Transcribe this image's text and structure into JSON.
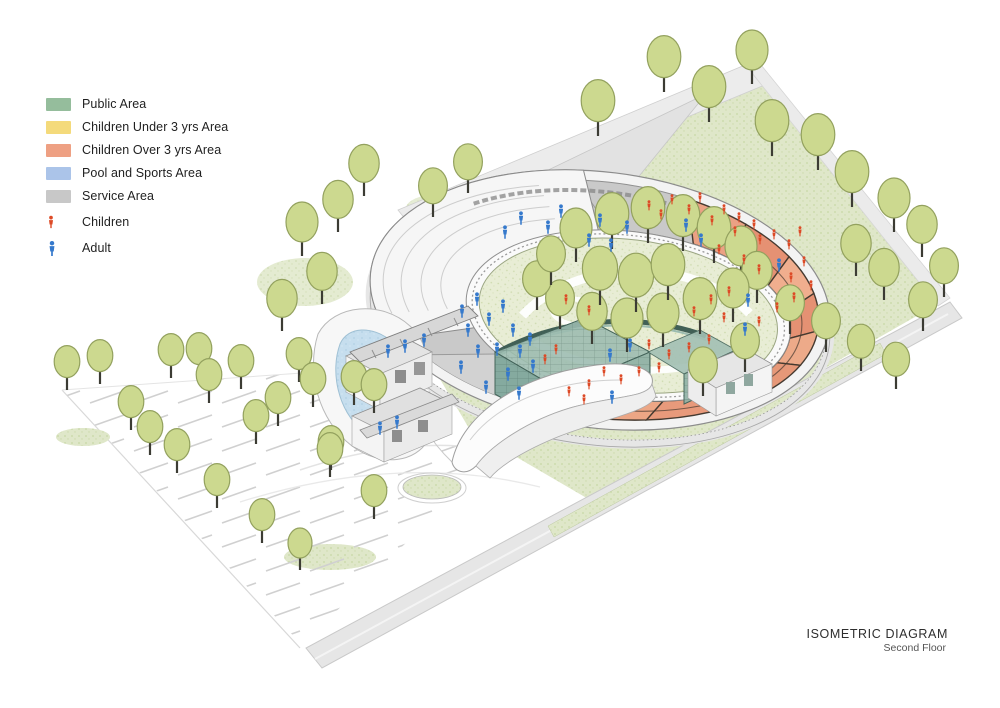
{
  "legend": {
    "items": [
      {
        "label": "Public Area",
        "color": "#95bd9c"
      },
      {
        "label": "Children Under 3 yrs Area",
        "color": "#f4da7b"
      },
      {
        "label": "Children Over 3 yrs Area",
        "color": "#eea083"
      },
      {
        "label": "Pool and Sports Area",
        "color": "#abc4e9"
      },
      {
        "label": "Service Area",
        "color": "#c8c8c8"
      }
    ],
    "figures": [
      {
        "label": "Children",
        "color": "#dd4a26",
        "icon": "child-figure-icon"
      },
      {
        "label": "Adult",
        "color": "#3579cc",
        "icon": "adult-figure-icon"
      }
    ]
  },
  "title": {
    "line1": "ISOMETRIC DIAGRAM",
    "line2": "Second Floor"
  },
  "colors": {
    "child_red": "#dd4a26",
    "adult_blue": "#3579cc",
    "tree_fill": "#ccd98f",
    "tree_stroke": "#93a15e",
    "trunk": "#3c3c34",
    "service_gray": "#c9c9c9",
    "over3_salmon": "#eba184",
    "glass_teal": "#9cbcb0",
    "glass_dark": "#2f5048",
    "pool_water": "#c6deee"
  },
  "scene": {
    "trees": {
      "courtyard": [
        [
          576,
          262,
          20
        ],
        [
          612,
          249,
          21
        ],
        [
          648,
          243,
          21
        ],
        [
          683,
          251,
          21
        ],
        [
          714,
          263,
          21
        ],
        [
          741,
          280,
          20
        ],
        [
          757,
          303,
          19
        ],
        [
          733,
          322,
          20
        ],
        [
          700,
          334,
          21
        ],
        [
          663,
          347,
          20
        ],
        [
          627,
          352,
          20
        ],
        [
          592,
          344,
          19
        ],
        [
          560,
          329,
          18
        ],
        [
          537,
          310,
          18
        ],
        [
          551,
          285,
          18
        ],
        [
          600,
          305,
          22
        ],
        [
          636,
          312,
          22
        ],
        [
          668,
          300,
          21
        ]
      ],
      "lawn": [
        [
          598,
          136,
          21
        ],
        [
          664,
          92,
          21
        ],
        [
          709,
          122,
          21
        ],
        [
          752,
          84,
          20
        ],
        [
          772,
          156,
          21
        ],
        [
          818,
          170,
          21
        ],
        [
          852,
          207,
          21
        ],
        [
          894,
          232,
          20
        ],
        [
          922,
          257,
          19
        ],
        [
          944,
          297,
          18
        ],
        [
          923,
          331,
          18
        ],
        [
          884,
          300,
          19
        ],
        [
          856,
          276,
          19
        ],
        [
          790,
          334,
          18
        ],
        [
          826,
          352,
          18
        ],
        [
          861,
          371,
          17
        ],
        [
          896,
          389,
          17
        ],
        [
          703,
          396,
          18
        ],
        [
          745,
          372,
          18
        ],
        [
          302,
          256,
          20
        ],
        [
          322,
          304,
          19
        ],
        [
          282,
          331,
          19
        ],
        [
          364,
          196,
          19
        ],
        [
          338,
          232,
          19
        ],
        [
          433,
          217,
          18
        ],
        [
          468,
          193,
          18
        ]
      ],
      "parking": [
        [
          67,
          390,
          16
        ],
        [
          100,
          384,
          16
        ],
        [
          131,
          430,
          16
        ],
        [
          171,
          378,
          16
        ],
        [
          199,
          377,
          16
        ],
        [
          209,
          403,
          16
        ],
        [
          241,
          389,
          16
        ],
        [
          256,
          444,
          16
        ],
        [
          278,
          426,
          16
        ],
        [
          299,
          382,
          16
        ],
        [
          313,
          407,
          16
        ],
        [
          331,
          470,
          16
        ],
        [
          354,
          405,
          16
        ],
        [
          374,
          413,
          16
        ],
        [
          177,
          473,
          16
        ],
        [
          217,
          508,
          16
        ],
        [
          262,
          543,
          16
        ],
        [
          330,
          477,
          16
        ],
        [
          374,
          519,
          16
        ],
        [
          300,
          570,
          15
        ],
        [
          150,
          455,
          16
        ]
      ]
    },
    "figures": {
      "adults": [
        [
          462,
          312
        ],
        [
          477,
          300
        ],
        [
          468,
          331
        ],
        [
          489,
          320
        ],
        [
          503,
          307
        ],
        [
          513,
          331
        ],
        [
          478,
          352
        ],
        [
          461,
          368
        ],
        [
          497,
          350
        ],
        [
          520,
          352
        ],
        [
          533,
          367
        ],
        [
          508,
          375
        ],
        [
          486,
          388
        ],
        [
          519,
          394
        ],
        [
          530,
          340
        ],
        [
          505,
          233
        ],
        [
          521,
          219
        ],
        [
          548,
          228
        ],
        [
          561,
          212
        ],
        [
          600,
          221
        ],
        [
          627,
          228
        ],
        [
          589,
          241
        ],
        [
          611,
          246
        ],
        [
          388,
          352
        ],
        [
          405,
          347
        ],
        [
          424,
          341
        ],
        [
          380,
          429
        ],
        [
          397,
          423
        ],
        [
          686,
          226
        ],
        [
          701,
          241
        ],
        [
          779,
          266
        ],
        [
          748,
          301
        ],
        [
          745,
          330
        ],
        [
          612,
          398
        ],
        [
          630,
          346
        ],
        [
          610,
          356
        ]
      ],
      "children": [
        [
          649,
          206
        ],
        [
          661,
          215
        ],
        [
          672,
          200
        ],
        [
          689,
          210
        ],
        [
          700,
          198
        ],
        [
          712,
          221
        ],
        [
          724,
          210
        ],
        [
          739,
          218
        ],
        [
          735,
          232
        ],
        [
          754,
          225
        ],
        [
          760,
          240
        ],
        [
          774,
          235
        ],
        [
          789,
          245
        ],
        [
          800,
          232
        ],
        [
          719,
          250
        ],
        [
          744,
          260
        ],
        [
          759,
          270
        ],
        [
          791,
          278
        ],
        [
          804,
          262
        ],
        [
          811,
          286
        ],
        [
          794,
          298
        ],
        [
          777,
          308
        ],
        [
          729,
          292
        ],
        [
          711,
          300
        ],
        [
          694,
          312
        ],
        [
          724,
          318
        ],
        [
          759,
          322
        ],
        [
          709,
          340
        ],
        [
          689,
          348
        ],
        [
          669,
          355
        ],
        [
          649,
          345
        ],
        [
          659,
          368
        ],
        [
          639,
          372
        ],
        [
          621,
          380
        ],
        [
          604,
          372
        ],
        [
          589,
          385
        ],
        [
          584,
          400
        ],
        [
          569,
          392
        ],
        [
          556,
          350
        ],
        [
          545,
          360
        ],
        [
          589,
          311
        ],
        [
          566,
          300
        ]
      ]
    }
  }
}
